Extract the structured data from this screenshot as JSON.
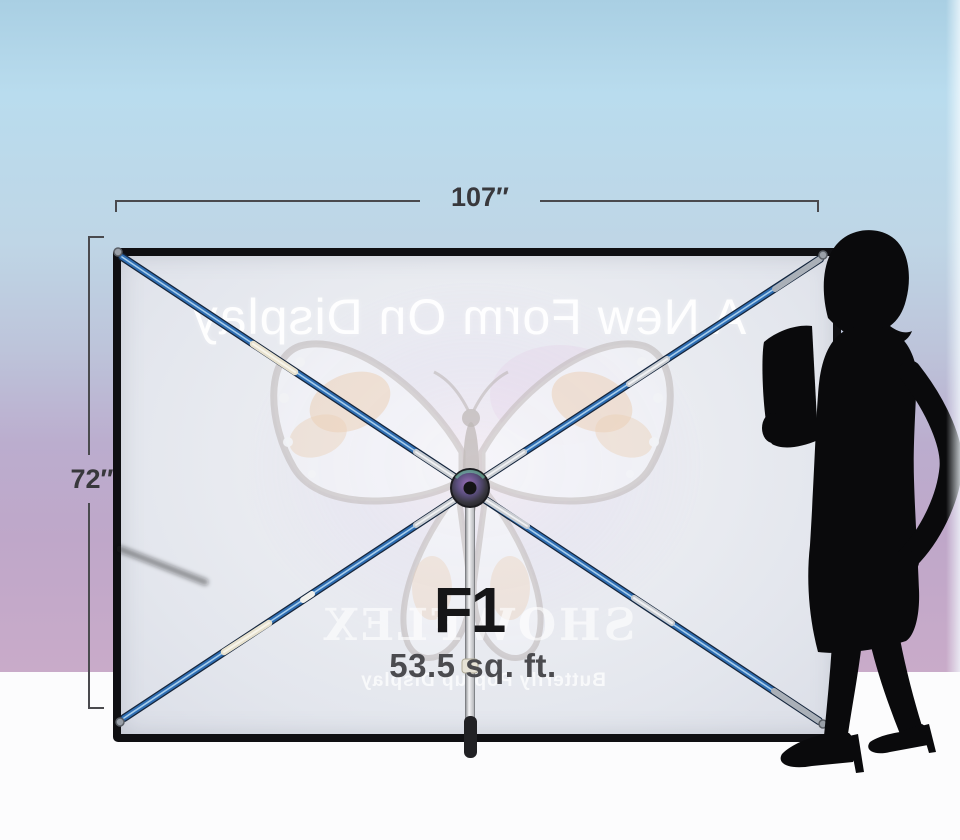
{
  "product_figure": {
    "dimensions": {
      "width_label": "107″",
      "height_label": "72″"
    },
    "model": {
      "name": "F1",
      "area": "53.5 sq. ft."
    },
    "banner_print_mirrored": {
      "headline": "A New Form On Display",
      "brand": "SHOWFLEX",
      "tagline": "Butterfly Pop-up Display"
    },
    "colors": {
      "sky_top": "#a9cfe3",
      "sky_blue": "#b9dcee",
      "sky_pink": "#c9abc9",
      "floor_white": "#fcfcfd",
      "fabric": "#e8eaef",
      "frame_black": "#0f0f12",
      "pole_blue": "#2e6db2",
      "pole_silver": "#c9cdd2",
      "pole_sleeve_cream": "#e8e2cf",
      "dimension_line": "#4a4a4e",
      "label_dark": "#161618",
      "label_gray": "#4b4b4f",
      "silhouette_black": "#0a0a0c"
    }
  }
}
